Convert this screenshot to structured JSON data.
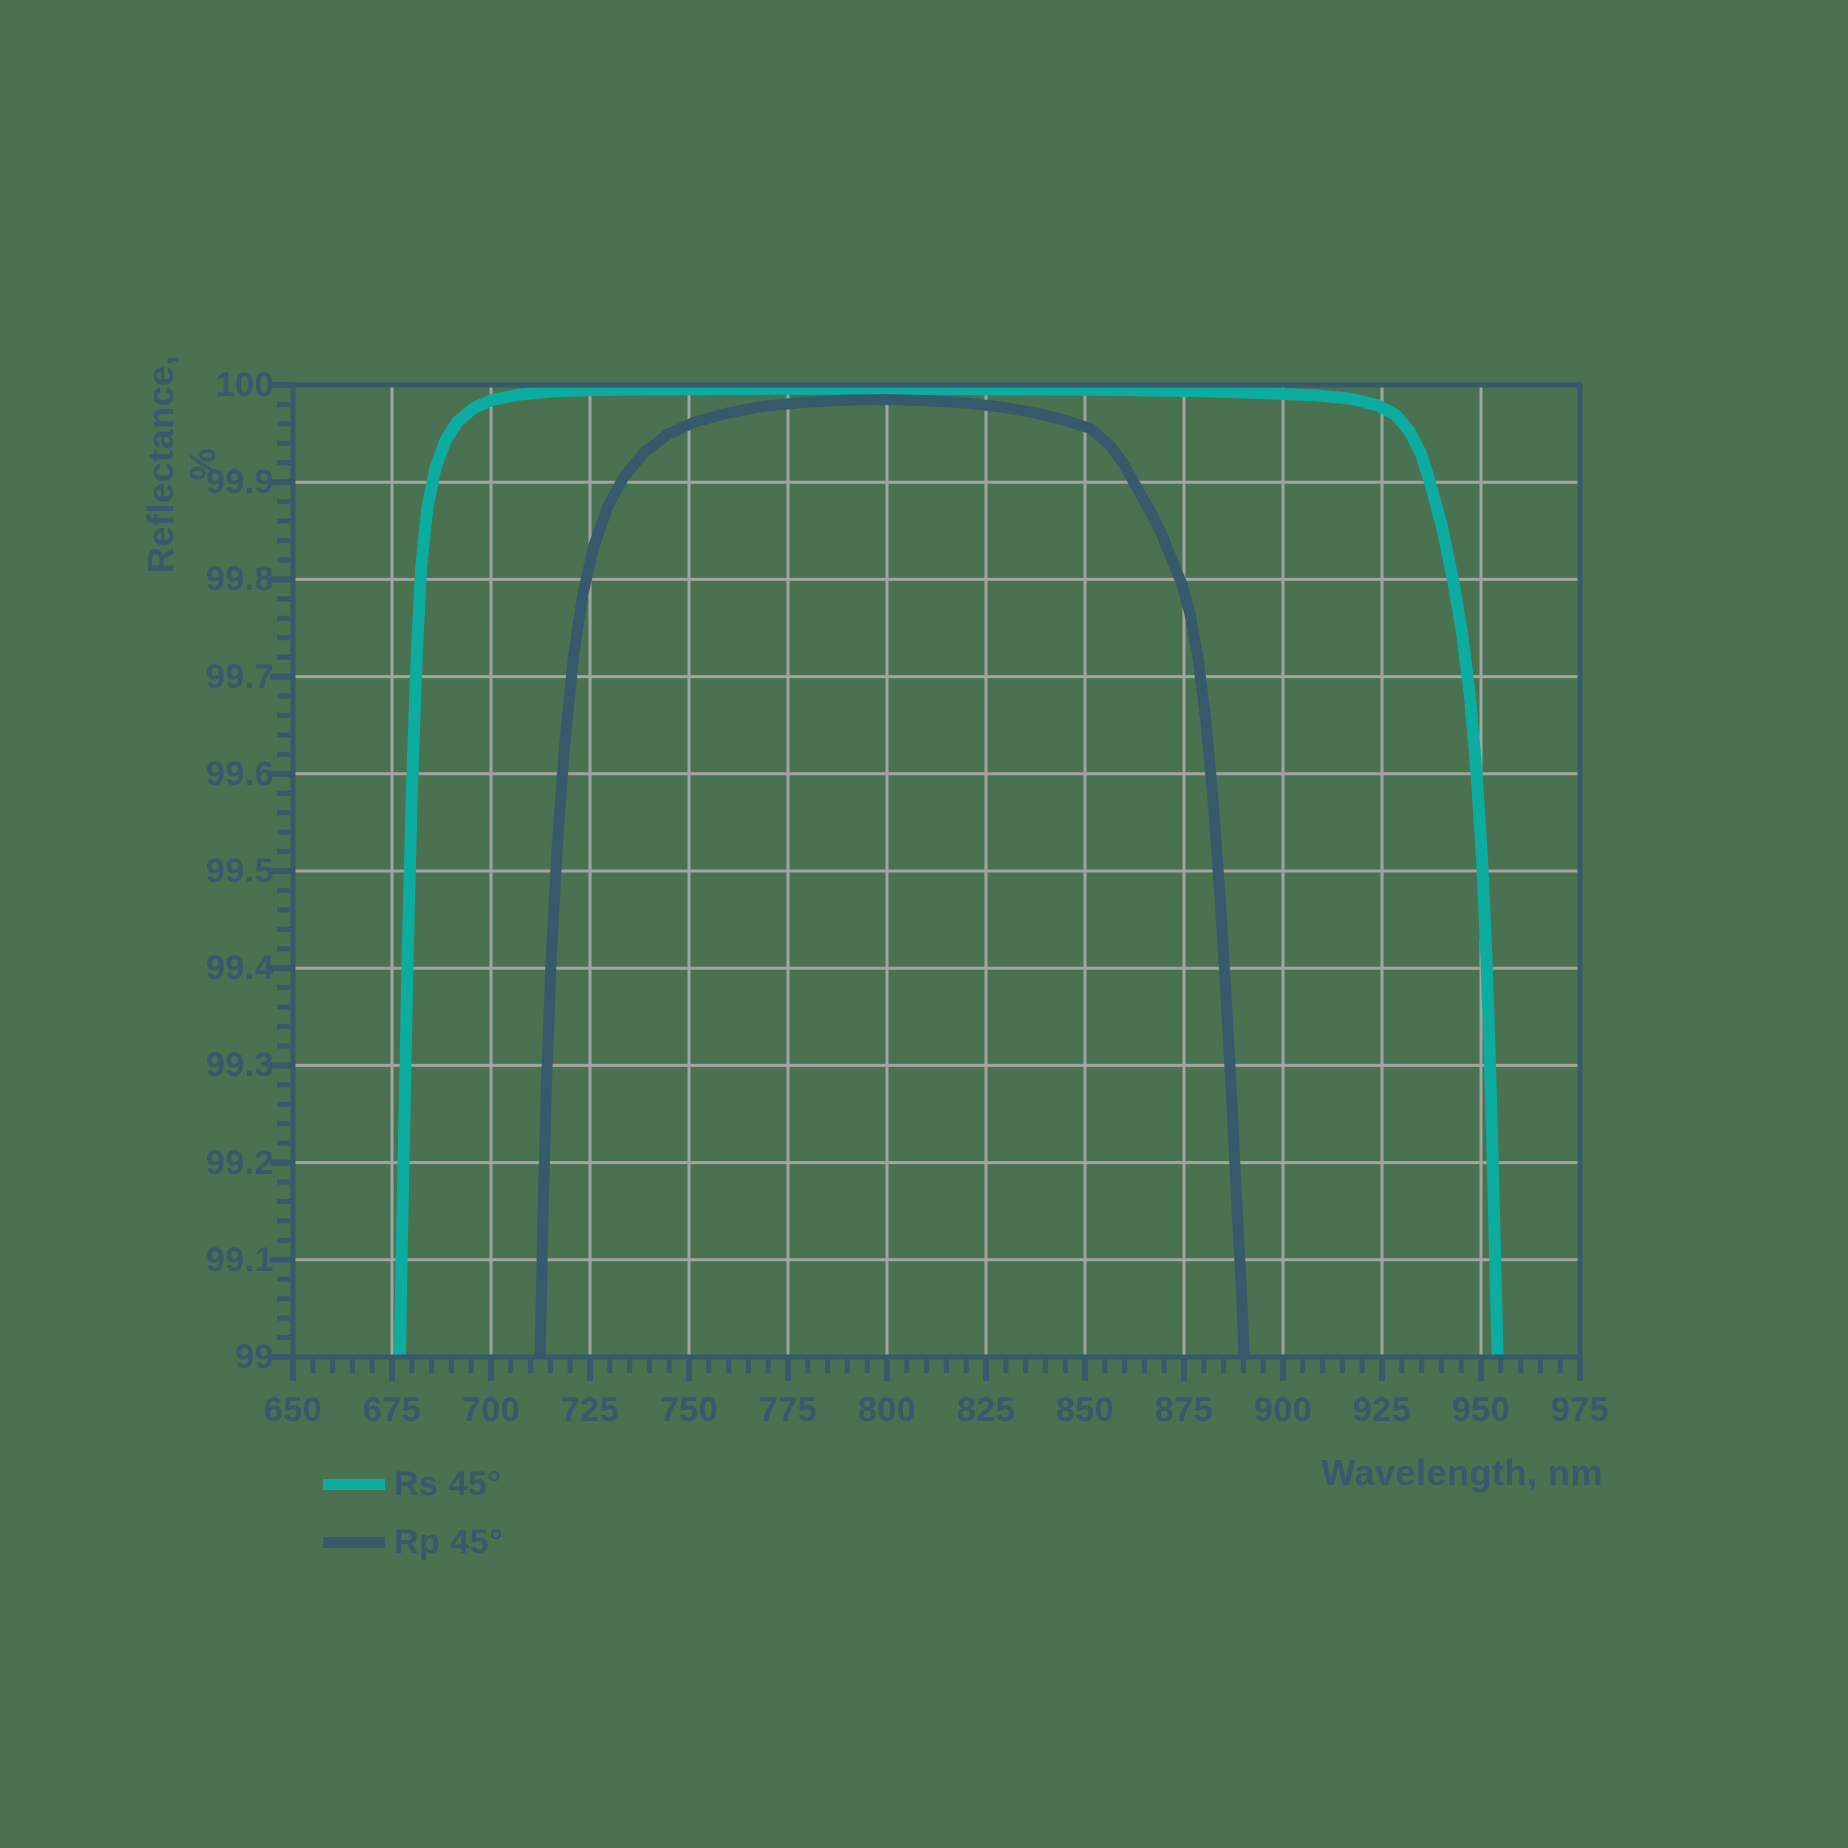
{
  "page": {
    "background_color": "#4A7150"
  },
  "chart_data": {
    "type": "line",
    "title": "",
    "xlabel": "Wavelength, nm",
    "ylabel": "Reflectance, %",
    "xlim": [
      650,
      975
    ],
    "ylim": [
      99,
      100
    ],
    "x_major_step": 25,
    "x_minor_step": 5,
    "y_major_step": 0.1,
    "y_minor_step": 0.02,
    "grid": true,
    "legend_position": "bottom-left",
    "x_tick_labels": [
      "650",
      "675",
      "700",
      "725",
      "750",
      "775",
      "800",
      "825",
      "850",
      "875",
      "900",
      "925",
      "950",
      "975"
    ],
    "y_tick_labels": [
      "100",
      "99.9",
      "99.8",
      "99.7",
      "99.6",
      "99.5",
      "99.4",
      "99.3",
      "99.2",
      "99.1",
      "99"
    ],
    "colors": {
      "background": "#4A7150",
      "grid": "#9FA69F",
      "axis": "#36596B",
      "text": "#36596B"
    },
    "series": [
      {
        "name": "Rs 45°",
        "color": "#0CACA0",
        "stroke_width": 12,
        "points": [
          [
            677.0,
            99.0
          ],
          [
            677.5,
            99.12
          ],
          [
            678.2,
            99.26
          ],
          [
            679.0,
            99.42
          ],
          [
            680.0,
            99.58
          ],
          [
            681.2,
            99.72
          ],
          [
            682.4,
            99.815
          ],
          [
            684.0,
            99.875
          ],
          [
            686.0,
            99.915
          ],
          [
            688.5,
            99.943
          ],
          [
            691.5,
            99.962
          ],
          [
            695.5,
            99.976
          ],
          [
            700.5,
            99.985
          ],
          [
            707.0,
            99.99
          ],
          [
            716.0,
            99.9935
          ],
          [
            728.0,
            99.995
          ],
          [
            745.0,
            99.9955
          ],
          [
            770.0,
            99.996
          ],
          [
            800.0,
            99.996
          ],
          [
            830.0,
            99.9955
          ],
          [
            858.0,
            99.995
          ],
          [
            880.0,
            99.9935
          ],
          [
            896.0,
            99.9915
          ],
          [
            908.0,
            99.9895
          ],
          [
            917.0,
            99.986
          ],
          [
            924.0,
            99.979
          ],
          [
            928.5,
            99.969
          ],
          [
            932.0,
            99.952
          ],
          [
            934.8,
            99.93
          ],
          [
            937.1,
            99.9
          ],
          [
            940.0,
            99.857
          ],
          [
            942.9,
            99.8
          ],
          [
            945.2,
            99.745
          ],
          [
            947.2,
            99.68
          ],
          [
            948.9,
            99.6
          ],
          [
            950.3,
            99.51
          ],
          [
            951.4,
            99.41
          ],
          [
            952.2,
            99.31
          ],
          [
            952.9,
            99.21
          ],
          [
            953.5,
            99.11
          ],
          [
            954.2,
            99.0
          ]
        ]
      },
      {
        "name": "Rp 45°",
        "color": "#36596B",
        "stroke_width": 11,
        "points": [
          [
            712.4,
            99.0
          ],
          [
            713.1,
            99.14
          ],
          [
            714.0,
            99.28
          ],
          [
            715.2,
            99.41
          ],
          [
            716.8,
            99.53
          ],
          [
            718.6,
            99.63
          ],
          [
            720.8,
            99.72
          ],
          [
            723.2,
            99.785
          ],
          [
            726.0,
            99.835
          ],
          [
            729.5,
            99.875
          ],
          [
            733.5,
            99.905
          ],
          [
            738.5,
            99.93
          ],
          [
            744.5,
            99.949
          ],
          [
            751.5,
            99.962
          ],
          [
            759.5,
            99.971
          ],
          [
            768.5,
            99.978
          ],
          [
            778.5,
            99.982
          ],
          [
            789.5,
            99.9845
          ],
          [
            800.0,
            99.985
          ],
          [
            810.0,
            99.984
          ],
          [
            820.0,
            99.9815
          ],
          [
            829.5,
            99.977
          ],
          [
            838.0,
            99.971
          ],
          [
            845.5,
            99.963
          ],
          [
            851.5,
            99.955
          ],
          [
            856.5,
            99.937
          ],
          [
            860.0,
            99.917
          ],
          [
            863.0,
            99.895
          ],
          [
            866.5,
            99.87
          ],
          [
            869.5,
            99.845
          ],
          [
            872.0,
            99.82
          ],
          [
            874.5,
            99.795
          ],
          [
            876.5,
            99.765
          ],
          [
            878.5,
            99.72
          ],
          [
            880.5,
            99.655
          ],
          [
            882.3,
            99.575
          ],
          [
            884.0,
            99.48
          ],
          [
            885.5,
            99.38
          ],
          [
            887.0,
            99.27
          ],
          [
            888.3,
            99.16
          ],
          [
            889.6,
            99.06
          ],
          [
            890.2,
            99.0
          ]
        ]
      }
    ]
  }
}
